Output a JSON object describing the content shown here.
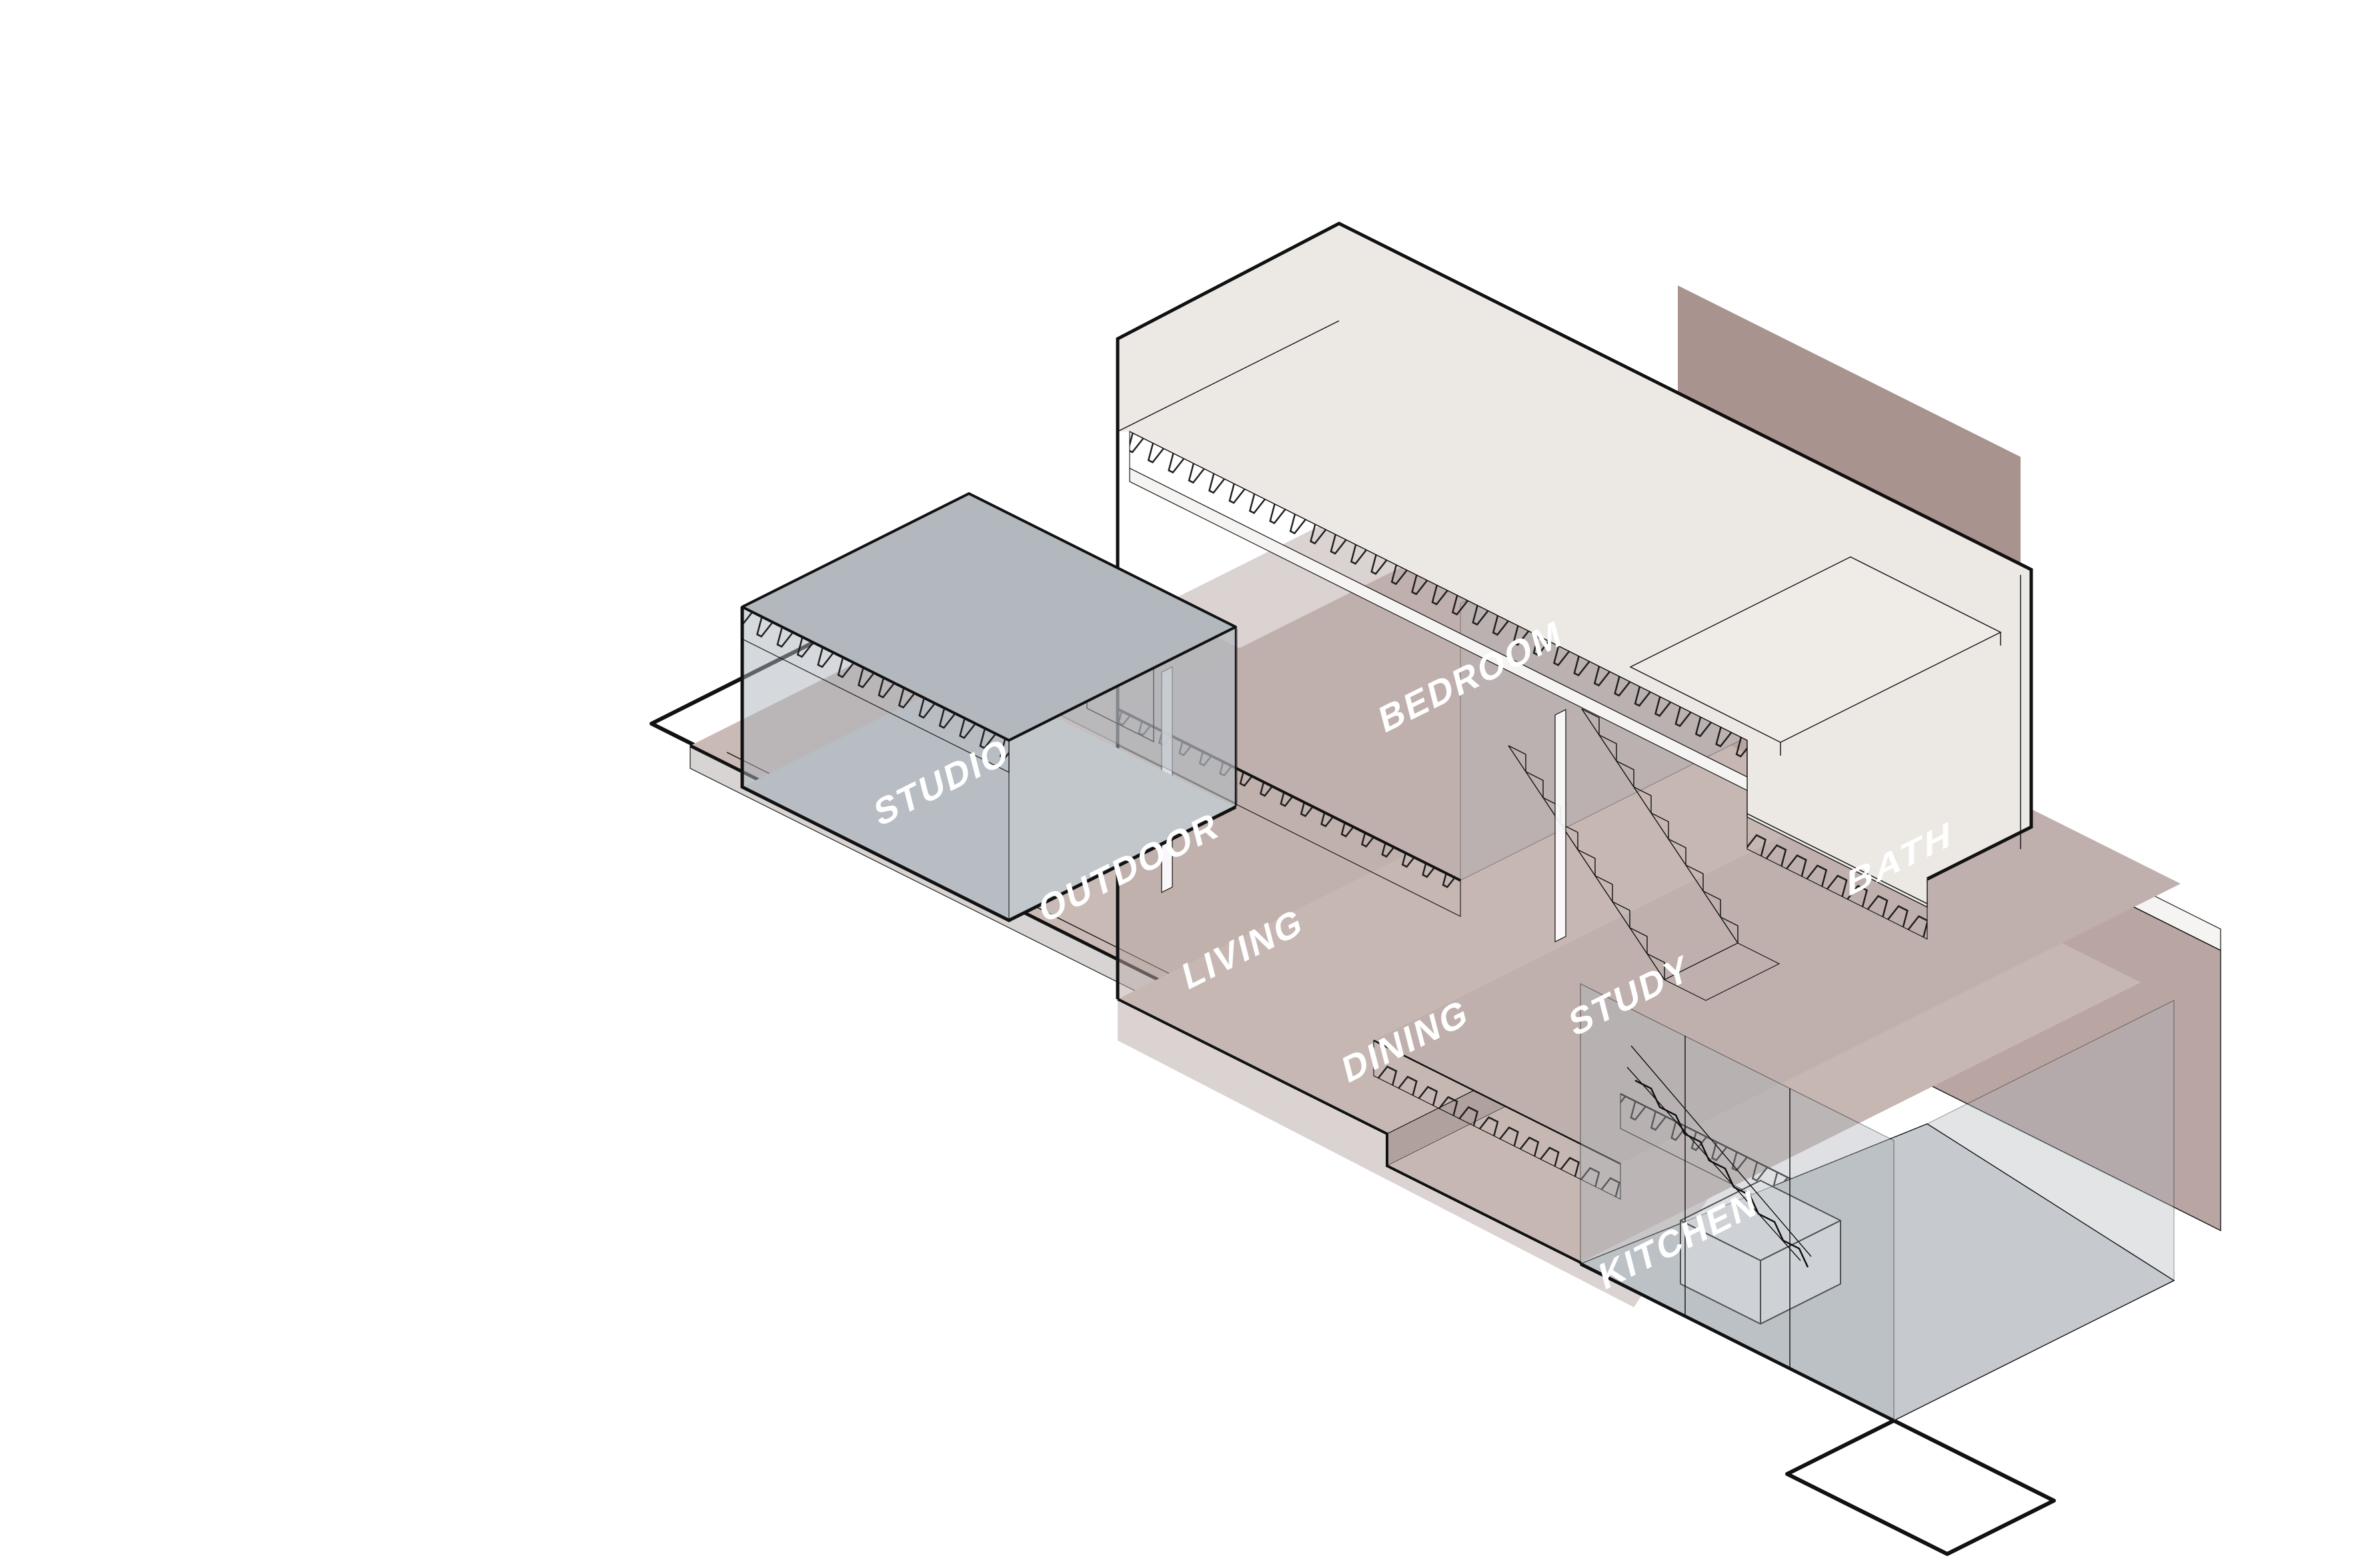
{
  "diagram": {
    "rooms": [
      {
        "id": "studio",
        "label": "STUDIO"
      },
      {
        "id": "outdoor",
        "label": "OUTDOOR"
      },
      {
        "id": "living",
        "label": "LIVING"
      },
      {
        "id": "dining",
        "label": "DINING"
      },
      {
        "id": "kitchen",
        "label": "KITCHEN"
      },
      {
        "id": "bedroom",
        "label": "BEDROOM"
      },
      {
        "id": "study",
        "label": "STUDY"
      },
      {
        "id": "bath",
        "label": "BATH"
      }
    ]
  },
  "palette": {
    "background": "#ffffff",
    "line": "#111111",
    "cream_wall": "#ece8e4",
    "slab_white": "#f6f4f2",
    "terrace_mauve": "#c9bab6",
    "floor_mauve": "#c6b7b3",
    "floor_mauve_dark": "#bfb0ad",
    "interior_pink": "#b7a7a4",
    "wall_pink": "#b49f9c",
    "wall_pink_dark": "#a8938f",
    "glass_gray": "#aeb4ba",
    "studio_roof_gray": "#b2b8be",
    "floor_gray": "#c6cace",
    "label_white": "#ffffff"
  }
}
